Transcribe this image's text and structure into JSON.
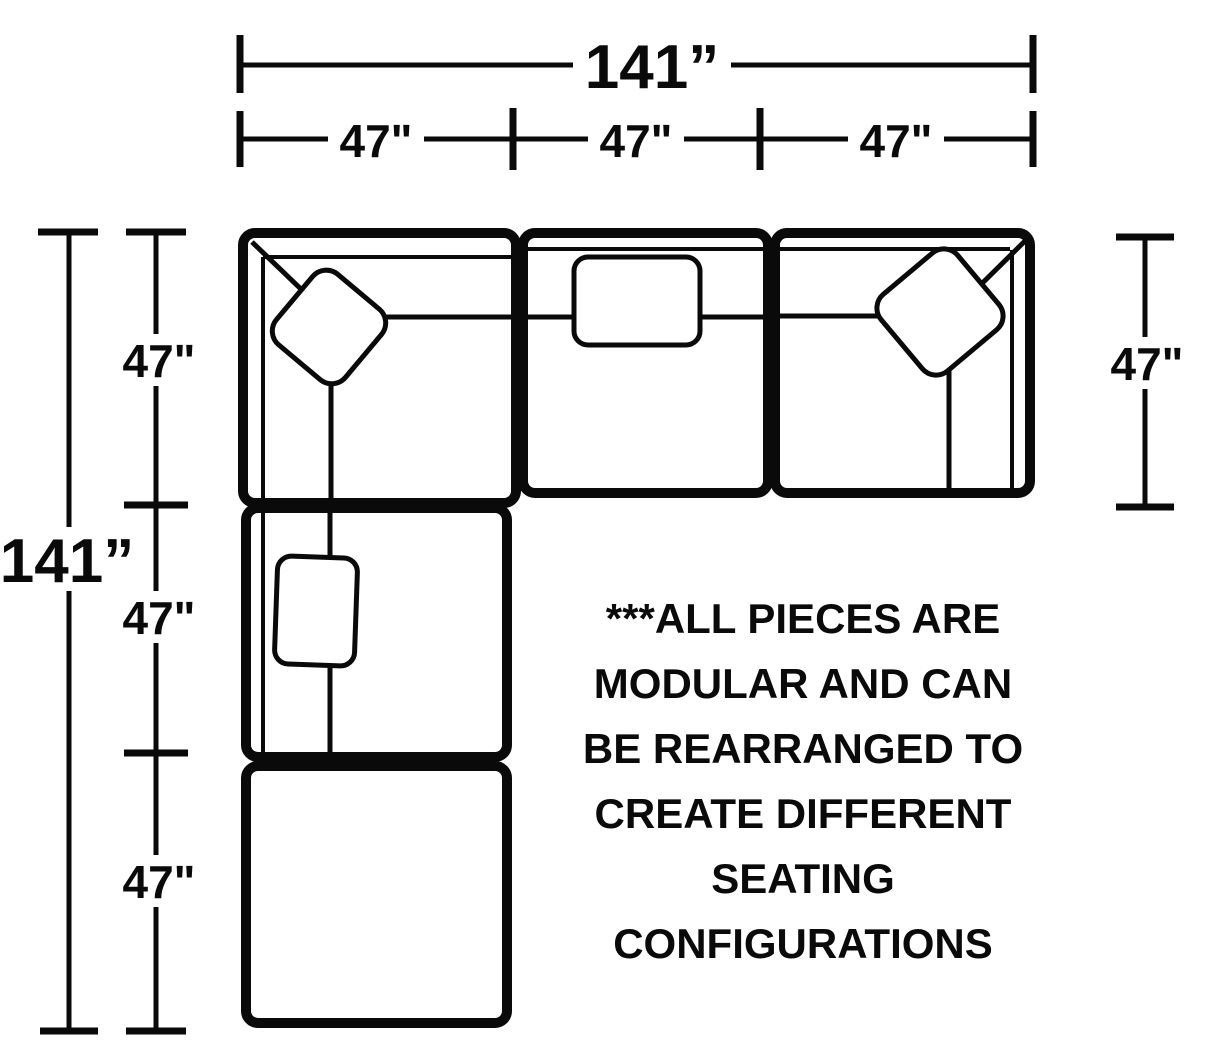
{
  "dimensions": {
    "top_total_label": "141”",
    "top_segment_labels": [
      "47\"",
      "47\"",
      "47\""
    ],
    "left_total_label": "141”",
    "left_segment_labels": [
      "47\"",
      "47\"",
      "47\""
    ],
    "right_segment_label": "47\"",
    "total_inches": 141,
    "segment_inches": 47
  },
  "note": {
    "lines": [
      "***ALL PIECES ARE",
      "MODULAR AND CAN",
      "BE REARRANGED TO",
      "CREATE DIFFERENT",
      "SEATING",
      "CONFIGURATIONS"
    ],
    "text": "***ALL PIECES ARE MODULAR AND CAN BE REARRANGED TO CREATE DIFFERENT SEATING CONFIGURATIONS"
  },
  "colors": {
    "line": "#0a0a0a",
    "background": "#ffffff"
  }
}
